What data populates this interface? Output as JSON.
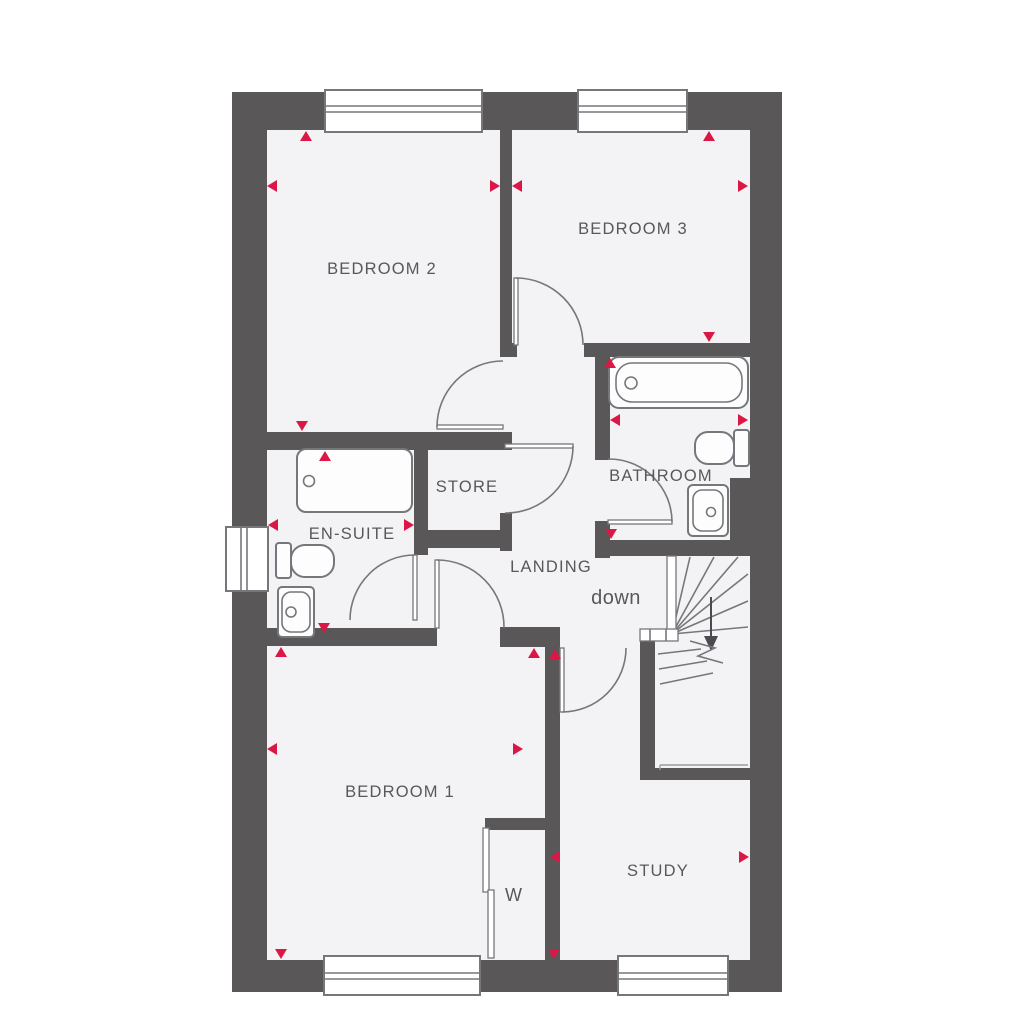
{
  "rooms": {
    "bedroom2": {
      "label": "BEDROOM 2"
    },
    "bedroom3": {
      "label": "BEDROOM 3"
    },
    "bathroom": {
      "label": "BATHROOM"
    },
    "ensuite": {
      "label": "EN-SUITE"
    },
    "store": {
      "label": "STORE"
    },
    "landing": {
      "label": "LANDING"
    },
    "bedroom1": {
      "label": "BEDROOM 1"
    },
    "study": {
      "label": "STUDY"
    },
    "wardrobe": {
      "label": "W"
    }
  },
  "stairs": {
    "direction_label": "down"
  },
  "fixtures": [
    "bath",
    "toilet",
    "basin",
    "shower",
    "ensuite-toilet",
    "ensuite-basin",
    "wardrobe-sliding-doors",
    "winder-staircase"
  ],
  "windows": [
    "bedroom2-top",
    "bedroom3-top",
    "ensuite-left",
    "bedroom1-bottom",
    "study-bottom"
  ],
  "colors": {
    "wall": "#595758",
    "floor": "#f3f3f5",
    "fixture_outline": "#76777b",
    "dimension_arrow": "#da1745",
    "label_text": "#57585c",
    "window_fill": "#ffffff",
    "background": "#ffffff"
  }
}
